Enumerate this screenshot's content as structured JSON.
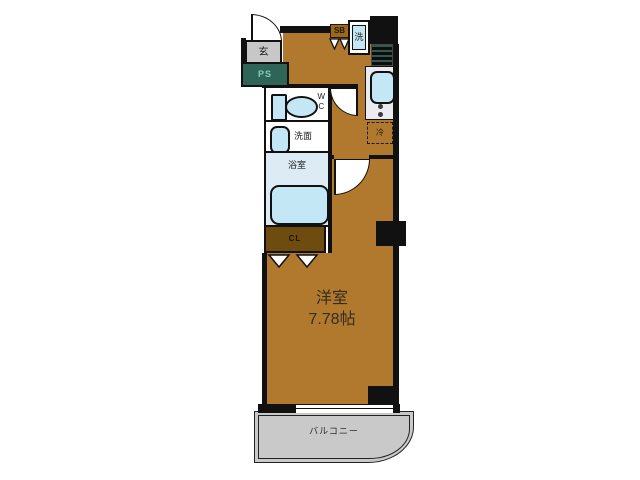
{
  "plan": {
    "entrance": {
      "label": "玄"
    },
    "pipe_space": {
      "label": "PS"
    },
    "shoe_box": {
      "label": "SB"
    },
    "washer": {
      "label": "洗"
    },
    "wc": {
      "label_line1": "W",
      "label_line2": "C"
    },
    "washroom": {
      "label": "洗面"
    },
    "bathroom": {
      "label": "浴室"
    },
    "closet": {
      "label": "CL"
    },
    "refrigerator": {
      "label": "冷"
    },
    "main_room": {
      "name": "洋室",
      "size": "7.78帖"
    },
    "balcony": {
      "label": "バルコニー"
    }
  },
  "colors": {
    "floor": "#B1792D",
    "wall": "#111111",
    "pipe_space_bg": "#2E6557",
    "pipe_space_text": "#7FCDB9",
    "entrance_bg": "#C7C7C7",
    "balcony_bg": "#C9C9C9",
    "bathroom_bg": "#DCEBF4",
    "fixture_fill": "#C3E7F4",
    "closet_bg": "#6E4B0F",
    "counter_bg": "#EAEAF0"
  }
}
